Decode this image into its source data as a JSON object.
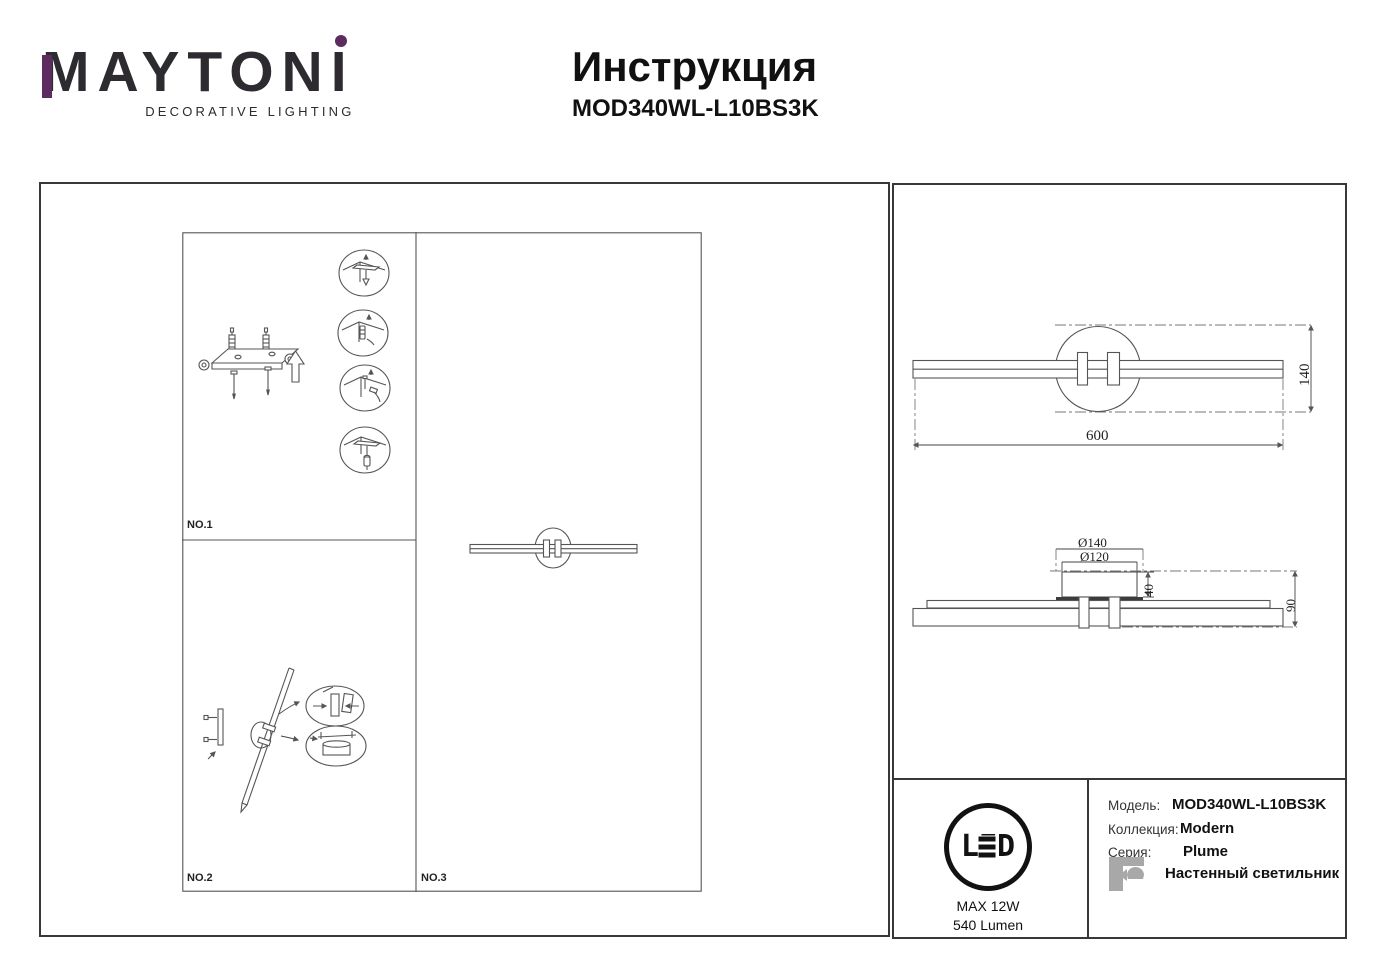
{
  "brand": {
    "name": "MAYTONI",
    "tagline": "DECORATIVE LIGHTING",
    "accent_color": "#5c2b60"
  },
  "doc": {
    "title": "Инструкция",
    "model": "MOD340WL-L10BS3K"
  },
  "install": {
    "step1": "NO.1",
    "step2": "NO.2",
    "step3": "NO.3"
  },
  "dims": {
    "front": {
      "width": "600",
      "height": "140"
    },
    "top": {
      "outer": "Ø140",
      "inner": "Ø120",
      "base_height": "40",
      "depth": "90"
    }
  },
  "spec": {
    "led": "LED",
    "power": "MAX 12W",
    "lumen": "540 Lumen",
    "model_label": "Модель:",
    "model_value": "MOD340WL-L10BS3K",
    "collection_label": "Коллекция:",
    "collection_value": "Modern",
    "series_label": "Серия:",
    "series_value": "Plume",
    "type_value": "Настенный светильник"
  },
  "colors": {
    "accent": "#5c2b60",
    "drawing_line": "#555555",
    "icon_gray": "#a8a8a8",
    "ink": "#111111"
  }
}
